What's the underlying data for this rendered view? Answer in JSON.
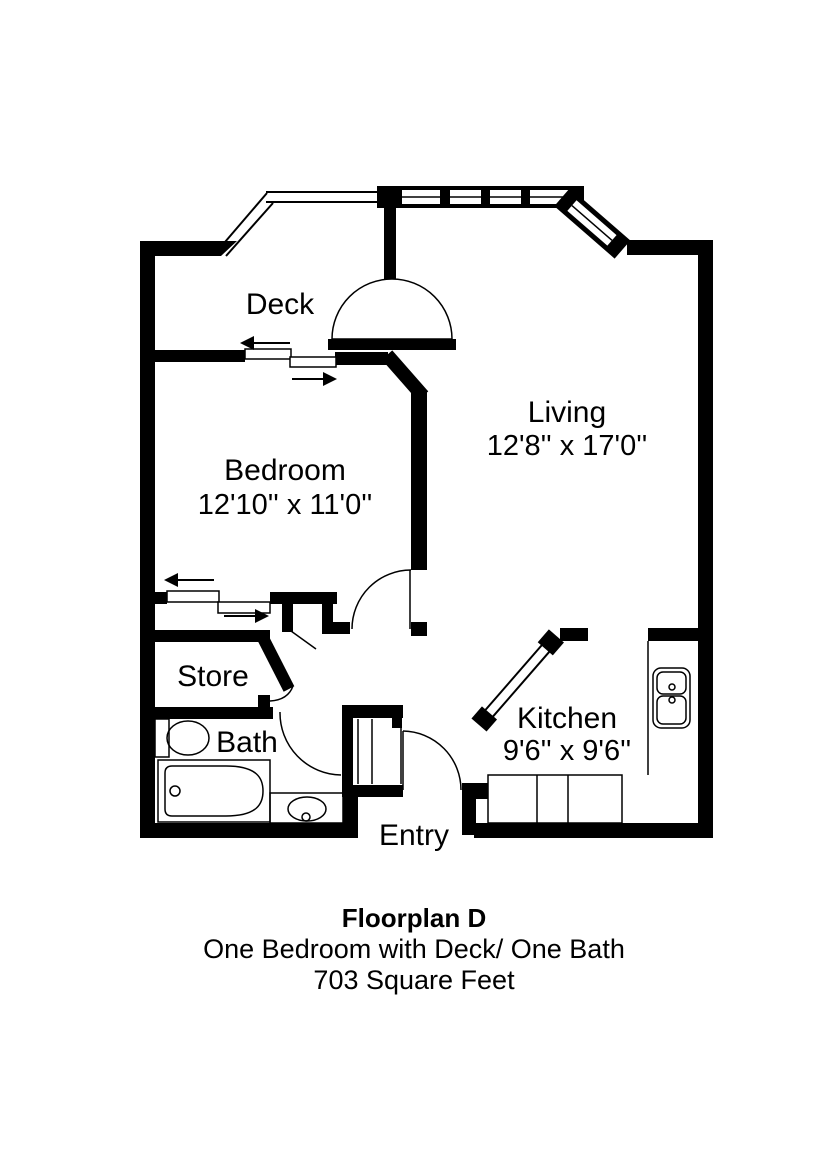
{
  "colors": {
    "line": "#000000",
    "background": "#ffffff"
  },
  "rooms": {
    "deck": {
      "label": "Deck"
    },
    "living": {
      "label": "Living",
      "dims": "12'8'' x 17'0''"
    },
    "bedroom": {
      "label": "Bedroom",
      "dims": "12'10'' x 11'0''"
    },
    "store": {
      "label": "Store"
    },
    "bath": {
      "label": "Bath"
    },
    "kitchen": {
      "label": "Kitchen",
      "dims": "9'6'' x 9'6''"
    },
    "entry": {
      "label": "Entry"
    }
  },
  "caption": {
    "title": "Floorplan D",
    "subtitle": "One Bedroom with Deck/ One Bath",
    "area": "703 Square Feet"
  }
}
